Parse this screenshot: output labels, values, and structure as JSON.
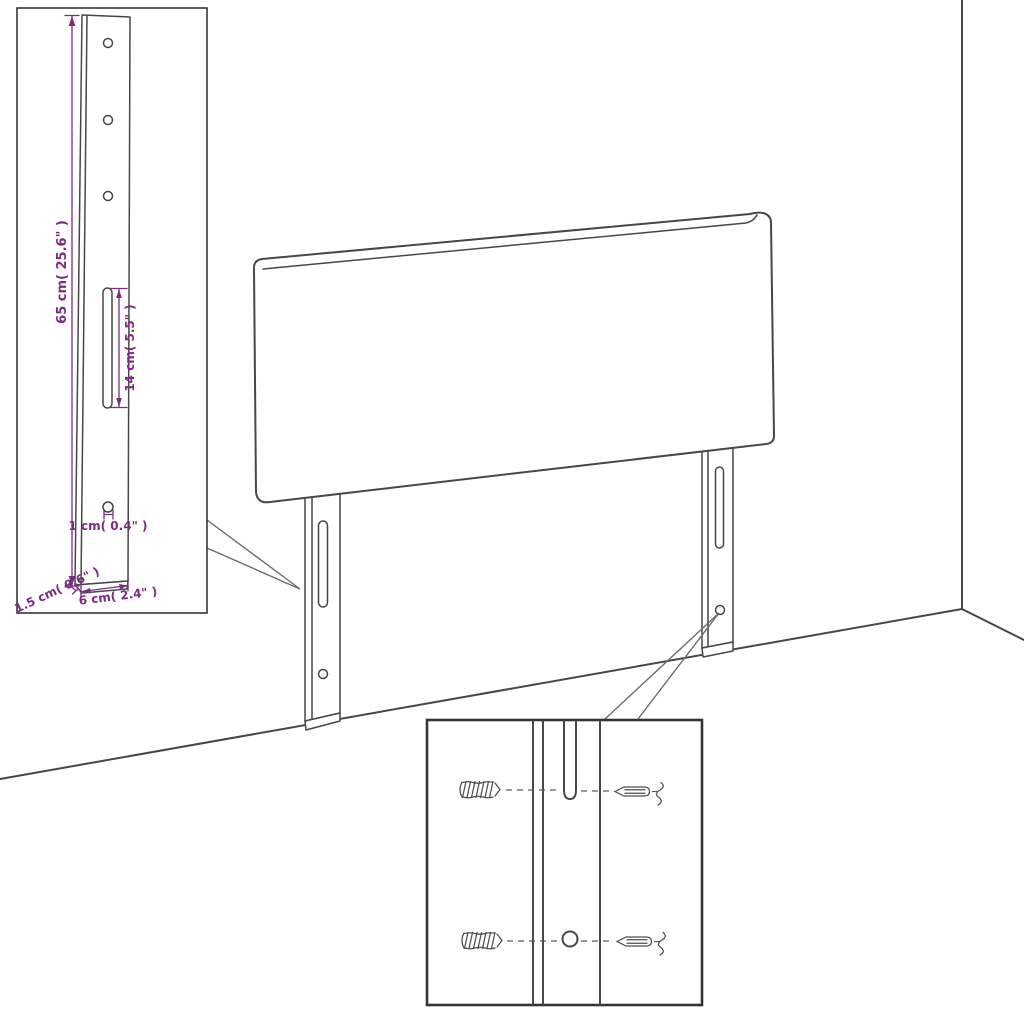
{
  "diagram": {
    "title_hidden": "",
    "dimensions": {
      "height_label": "65 cm( 25.6\" )",
      "slot_label": "14 cm( 5.5\" )",
      "hole_label": "1 cm( 0.4\" )",
      "thickness_label": "1.5 cm( 0.6\" )",
      "width_label": "6 cm( 2.4\" )"
    },
    "colors": {
      "line": "#474747",
      "accent": "#7d2b80",
      "box_border": "#353535",
      "background": "#ffffff"
    },
    "icons": {
      "wall_plug": "wall-plug-icon",
      "screw": "screw-icon"
    }
  }
}
